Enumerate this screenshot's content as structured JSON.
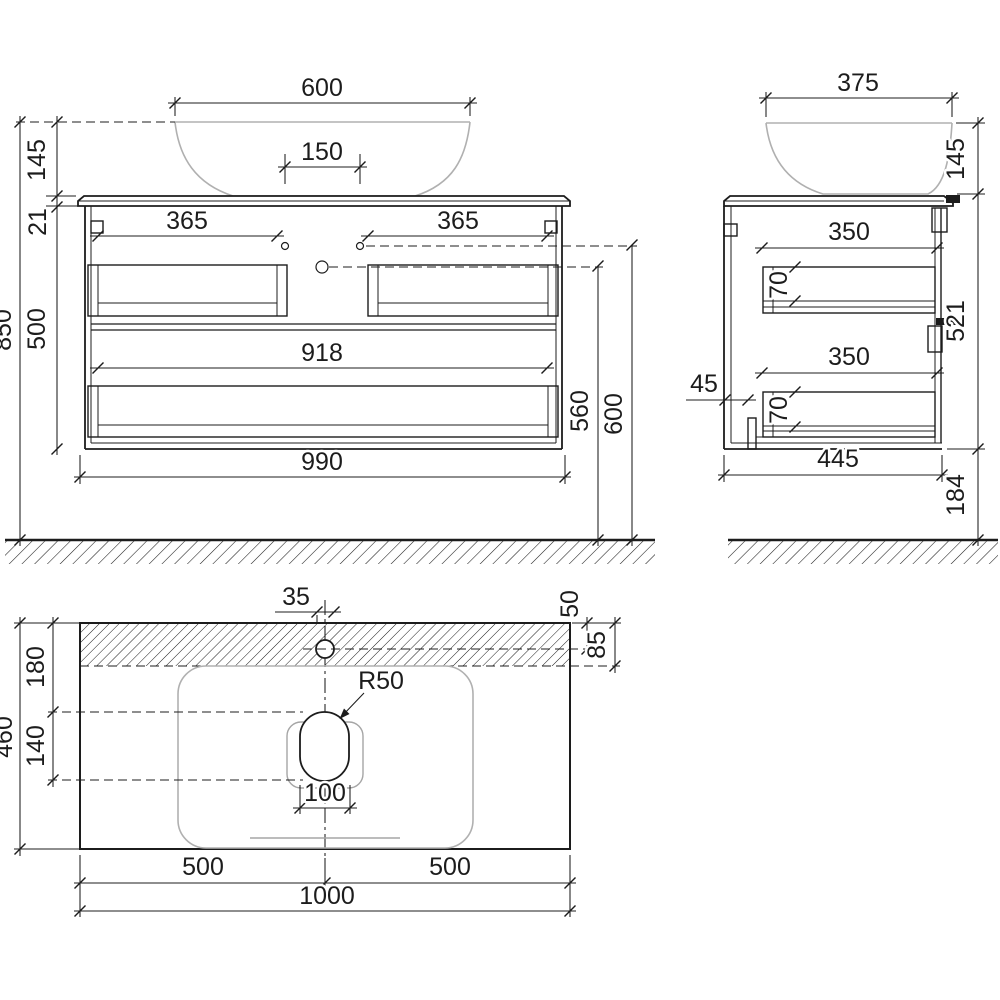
{
  "meta": {
    "background_color": "#ffffff",
    "line_color": "#1c1c1c",
    "ceramic_color": "#b0b0b0"
  },
  "front_view": {
    "dims": {
      "sink_width": "600",
      "faucet_spacing": "150",
      "sink_height": "145",
      "top_thickness": "21",
      "handle_width_left": "365",
      "handle_width_right": "365",
      "body_height": "500",
      "total_height": "850",
      "inner_width": "918",
      "cabinet_width": "990",
      "outlet_height": "560",
      "mount_height": "600"
    }
  },
  "side_view": {
    "dims": {
      "sink_width": "375",
      "sink_height": "145",
      "drawer_depth_top": "350",
      "drawer_side_top": "70",
      "drawer_depth_bottom": "350",
      "drawer_side_bottom": "70",
      "foot_inset": "45",
      "cabinet_depth": "445",
      "body_height": "521",
      "floor_clearance": "184"
    }
  },
  "top_view": {
    "dims": {
      "faucet_offset": "35",
      "faucet_from_back": "50",
      "basin_from_back": "85",
      "back_zone_depth": "180",
      "drain_zone_depth": "140",
      "counter_depth": "460",
      "drain_radius": "R50",
      "drain_width": "100",
      "half_width_left": "500",
      "half_width_right": "500",
      "counter_width": "1000"
    }
  }
}
